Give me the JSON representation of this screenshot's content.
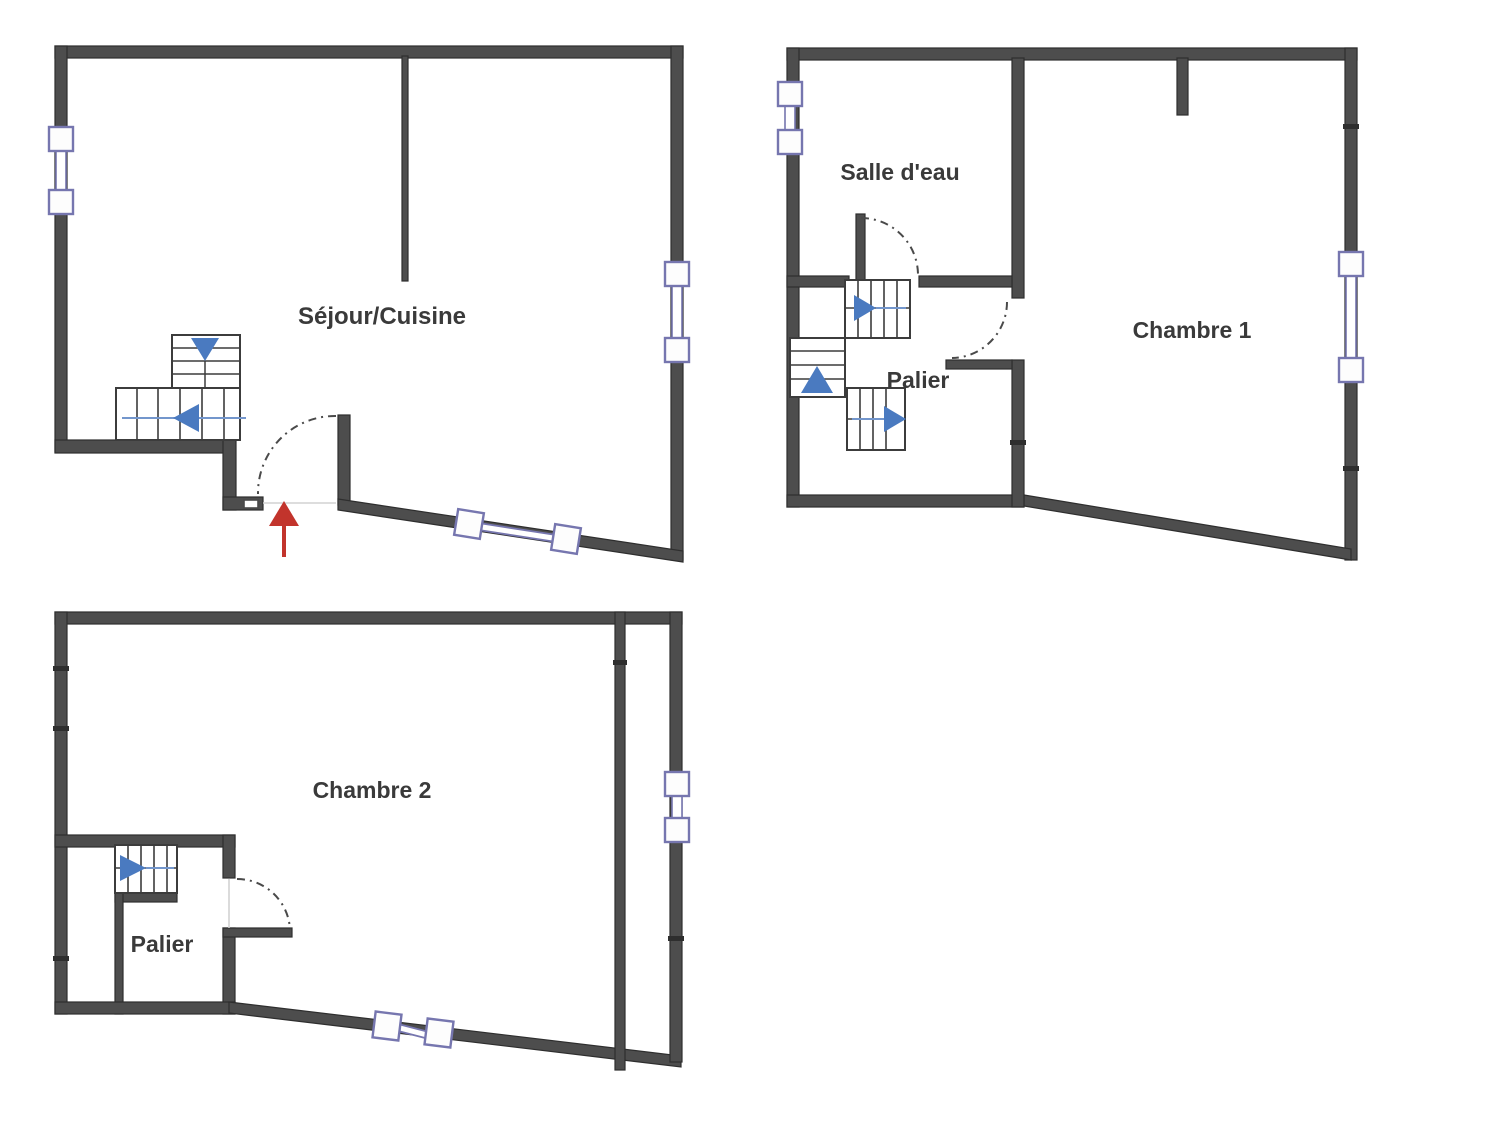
{
  "labels": {
    "ground_main_room": "Séjour/Cuisine",
    "first_bathroom": "Salle d'eau",
    "first_bedroom": "Chambre 1",
    "first_landing": "Palier",
    "second_bedroom": "Chambre 2",
    "second_landing": "Palier"
  },
  "symbols": {
    "entrance_arrow": "red-up-arrow-entrance",
    "stair_direction_arrow": "blue-triangle-stair-direction",
    "window": "double-line-with-square-jambs",
    "door": "dashed-quarter-arc-swing"
  },
  "colors": {
    "background": "#ffffff",
    "wall_fill": "#4d4d4d",
    "wall_edge": "#2e2e2e",
    "window_frame": "#7676af",
    "window_fill": "#fdfdfd",
    "stair_arrow_blue": "#4a7ac0",
    "stair_line_blue": "#7396cc",
    "entry_arrow_red": "#c2342c",
    "door_arc": "#4a4a4a",
    "label_text": "#3a3a3a"
  }
}
